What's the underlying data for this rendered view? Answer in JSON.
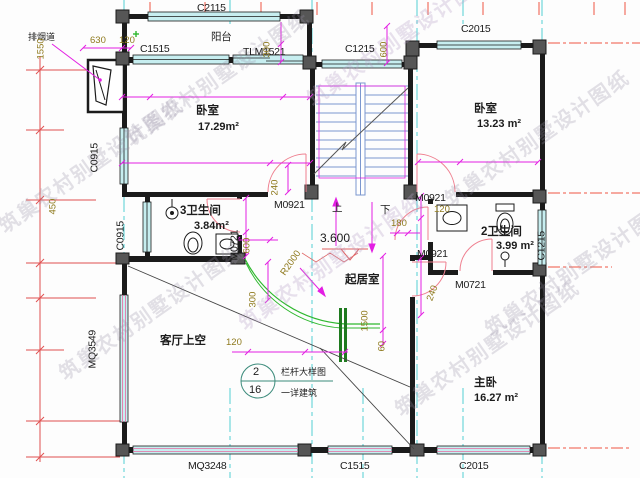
{
  "watermark": "筑巢农村别墅设计图纸",
  "rooms": {
    "balcony": "阳台",
    "bedroom1": {
      "name": "卧室",
      "area": "17.29m²"
    },
    "bedroom2": {
      "name": "卧室",
      "area": "13.23 m²"
    },
    "bath3": {
      "name": "3卫生间",
      "area": "3.84m²"
    },
    "bath2": {
      "name": "2卫生间",
      "area": "3.99 m²"
    },
    "living": "起居室",
    "void": "客厅上空",
    "master": {
      "name": "主卧",
      "area": "16.27 m²"
    }
  },
  "openings": {
    "c2115": "C2115",
    "c1515_top": "C1515",
    "tlm1521": "TLM1521",
    "c1215_top": "C1215",
    "c2015_top": "C2015",
    "c0915_upper": "C0915",
    "c0915_lower": "C0915",
    "mq3549": "MQ3549",
    "mq3248": "MQ3248",
    "c1515_bottom": "C1515",
    "c2015_bottom": "C2015",
    "c1215_right": "C1215",
    "m0921_bed1": "M0921",
    "m0921_hall": "M0921",
    "m0921_master": "M0921",
    "m0721_bath3": "M0721",
    "m0721_bath2": "M0721"
  },
  "dims": {
    "d630": "630",
    "d120_top": "120",
    "d300_top": "300",
    "d600_top": "600",
    "d1550": "1550",
    "d450": "450",
    "d240_bed1": "240",
    "d180": "180",
    "d120_hall": "120",
    "d600_bath3": "600",
    "d300_rail": "300",
    "r2000": "R2000",
    "d1500": "1500",
    "d60": "60",
    "d120_callout": "120",
    "d240_master": "240"
  },
  "stair": {
    "up": "上",
    "down": "下"
  },
  "level": {
    "value": "3.600"
  },
  "callout": {
    "number": "2",
    "sheet": "16",
    "title": "栏杆大样图",
    "note": "一详建筑"
  },
  "flue": {
    "label": "排烟道"
  },
  "accent_colors": {
    "wall": "#1b1b1b",
    "window_fill": "#c7eef0",
    "dimension": "#e31ee3",
    "axis_red": "#ee5544",
    "axis_cyan": "#52cfd4",
    "stair_blue": "#7b97cf",
    "railing_green": "#2eb82e",
    "door_pink": "#ef8090",
    "dim_text": "#8f7a1e"
  }
}
